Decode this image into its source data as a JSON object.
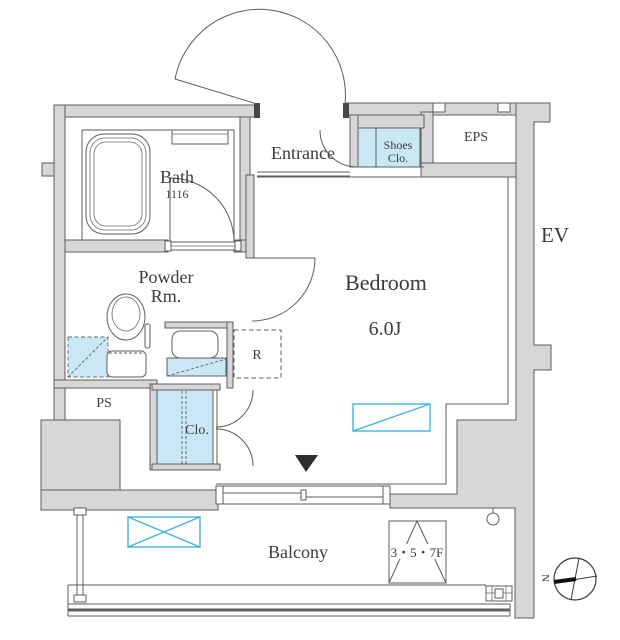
{
  "floorplan": {
    "rooms": {
      "bath": {
        "label": "Bath",
        "size": "1116"
      },
      "powder_room": {
        "label_line1": "Powder",
        "label_line2": "Rm."
      },
      "entrance": {
        "label": "Entrance"
      },
      "shoes_closet": {
        "label_line1": "Shoes",
        "label_line2": "Clo."
      },
      "eps": {
        "label": "EPS"
      },
      "elevator": {
        "label": "EV"
      },
      "bedroom": {
        "label": "Bedroom",
        "size": "6.0J"
      },
      "refrigerator": {
        "label": "R"
      },
      "pipe_space": {
        "label": "PS"
      },
      "closet": {
        "label": "Clo."
      },
      "balcony": {
        "label": "Balcony"
      },
      "floor_note": {
        "label": "3・5・7F"
      }
    },
    "compass": {
      "north_label": "N"
    },
    "symbols": {
      "ac_indoor_unit": "rectangle-with-single-diagonal",
      "ac_outdoor_unit": "rectangle-with-x",
      "entry_marker": "filled-down-triangle"
    },
    "colors": {
      "wall_fill": "#d7d7d7",
      "line": "#5e5e5e",
      "fixture_blue_fill": "#c9e7f5",
      "accent_cyan": "#3fb3de",
      "background": "#ffffff"
    }
  }
}
